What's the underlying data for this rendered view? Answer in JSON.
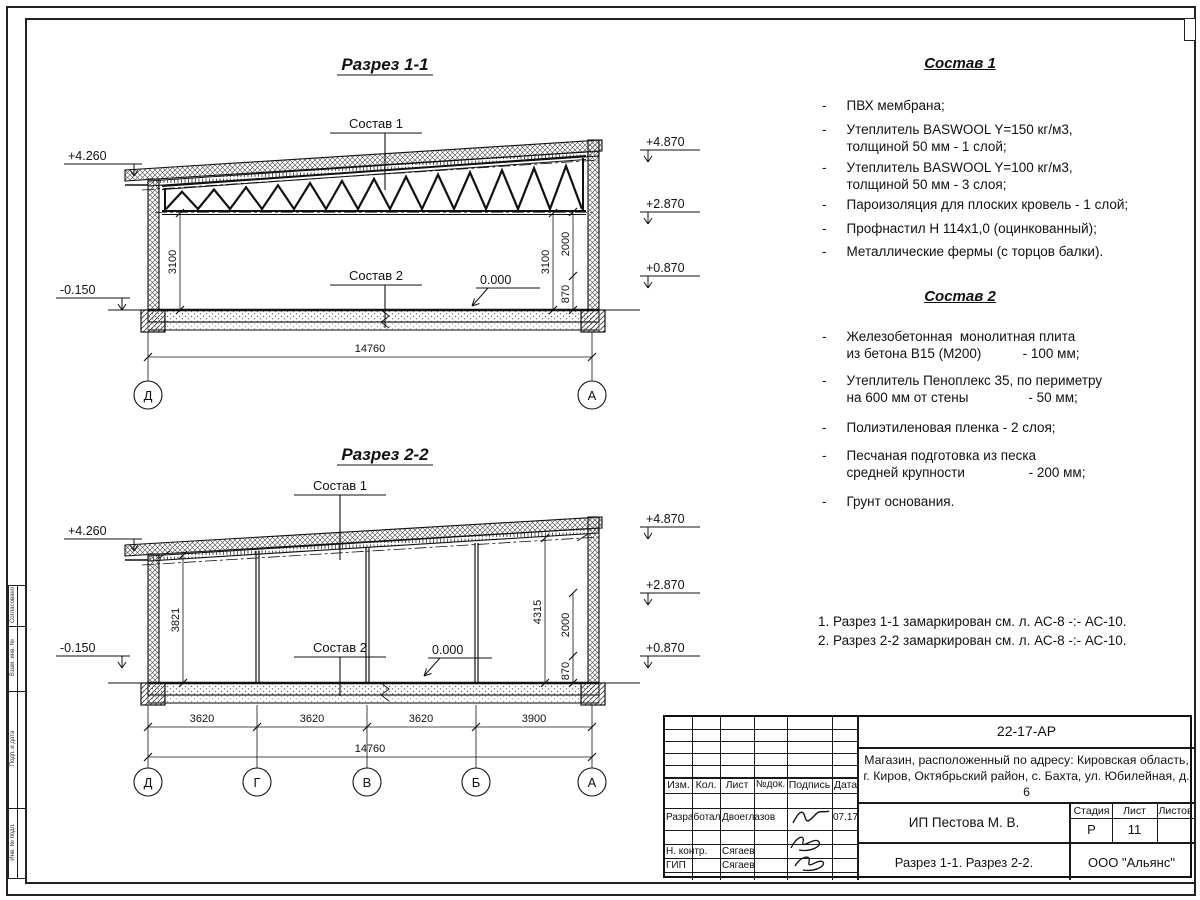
{
  "frame": {
    "side_strip_labels": [
      "Согласовано",
      "Взам. инв. №",
      "Подп. и дата",
      "Инв. № подл."
    ]
  },
  "sections": {
    "s11": {
      "title": "Разрез 1-1",
      "sostav1_label": "Состав 1",
      "sostav2_label": "Состав 2",
      "elev_left_top": "+4.260",
      "elev_left_bottom": "-0.150",
      "elev_right_1": "+4.870",
      "elev_right_2": "+2.870",
      "elev_right_3": "+0.870",
      "elev_zero": "0.000",
      "dim_left_height": "3100",
      "dim_right_height": "3100",
      "dim_2000": "2000",
      "dim_870": "870",
      "dim_total": "14760",
      "grid": [
        "Д",
        "А"
      ]
    },
    "s22": {
      "title": "Разрез 2-2",
      "sostav1_label": "Состав 1",
      "sostav2_label": "Состав 2",
      "elev_left_top": "+4.260",
      "elev_left_bottom": "-0.150",
      "elev_right_1": "+4.870",
      "elev_right_2": "+2.870",
      "elev_right_3": "+0.870",
      "elev_zero": "0.000",
      "dim_left_height": "3821",
      "dim_right_height": "4315",
      "dim_2000": "2000",
      "dim_870": "870",
      "bays": [
        "3620",
        "3620",
        "3620",
        "3900"
      ],
      "dim_total": "14760",
      "grid": [
        "Д",
        "Г",
        "В",
        "Б",
        "А"
      ]
    }
  },
  "sostav1": {
    "title": "Состав 1",
    "items": [
      "ПВХ мембрана;",
      "Утеплитель BASWOOL Y=150 кг/м3,\nтолщиной 50 мм - 1 слой;",
      "Утеплитель BASWOOL Y=100 кг/м3,\nтолщиной 50 мм - 3 слоя;",
      "Пароизоляция для плоских кровель - 1 слой;",
      "Профнастил Н 114х1,0 (оцинкованный);",
      "Металлические фермы (с торцов балки)."
    ]
  },
  "sostav2": {
    "title": "Состав 2",
    "items": [
      "Железобетонная  монолитная плита\nиз бетона В15 (М200)           - 100 мм;",
      "Утеплитель Пеноплекс 35, по периметру\nна 600 мм от стены                - 50 мм;",
      "Полиэтиленовая пленка - 2 слоя;",
      "Песчаная подготовка из песка\nсредней крупности                 - 200 мм;",
      "Грунт основания."
    ]
  },
  "notes": [
    "1. Разрез 1-1 замаркирован см. л. АС-8 -:- АС-10.",
    "2. Разрез 2-2 замаркирован см. л. АС-8 -:- АС-10."
  ],
  "titleblock": {
    "doc_number": "22-17-АР",
    "address_line1": "Магазин, расположенный по адресу: Кировская область,",
    "address_line2": "г. Киров, Октябрьский район, с. Бахта, ул. Юбилейная, д. 6",
    "cols": [
      "Изм.",
      "Кол.",
      "Лист",
      "№док.",
      "Подпись",
      "Дата"
    ],
    "rows": [
      {
        "role": "Разработал",
        "name": "Двоеглазов",
        "date": "07.17"
      },
      {
        "role": "Н. контр.",
        "name": "Сягаев",
        "date": ""
      },
      {
        "role": "ГИП",
        "name": "Сягаев",
        "date": ""
      }
    ],
    "client": "ИП Пестова М. В.",
    "stage_header": "Стадия",
    "sheet_header": "Лист",
    "sheets_header": "Листов",
    "stage": "Р",
    "sheet": "11",
    "sheets": "",
    "sheet_title": "Разрез 1-1. Разрез 2-2.",
    "company": "ООО \"Альянс\""
  }
}
